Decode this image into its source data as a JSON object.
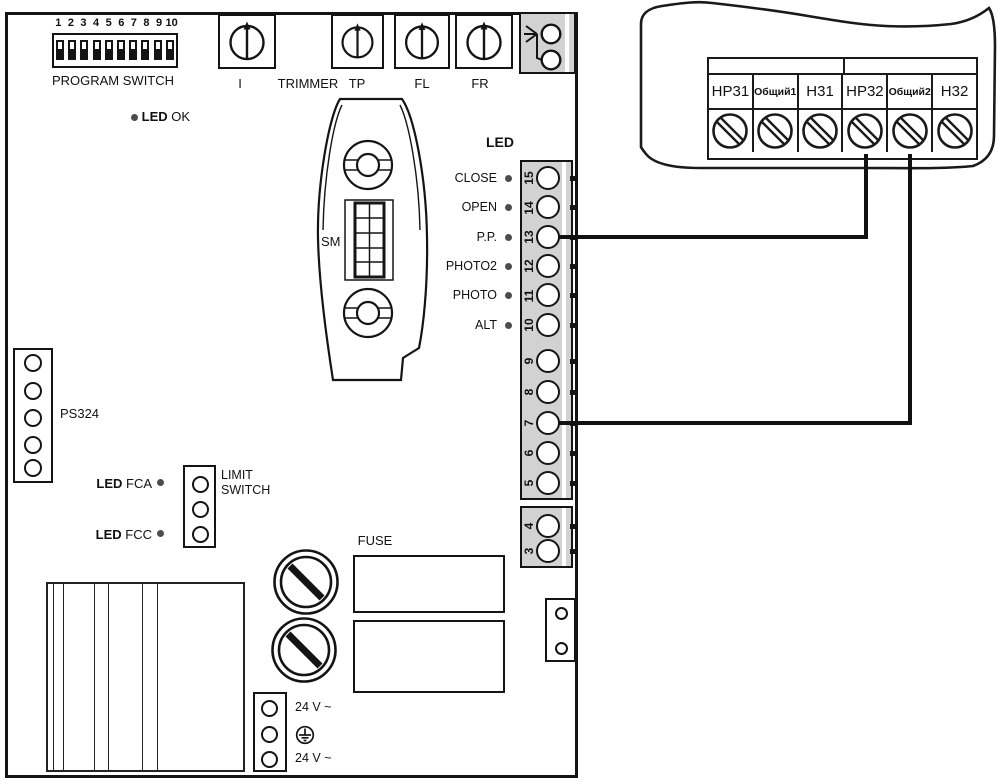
{
  "board": {
    "dip": {
      "numbers": [
        "1",
        "2",
        "3",
        "4",
        "5",
        "6",
        "7",
        "8",
        "9",
        "10"
      ],
      "label": "PROGRAM SWITCH"
    },
    "trimmers": {
      "i": "I",
      "trimmer": "TRIMMER",
      "tp": "TP",
      "fl": "FL",
      "fr": "FR"
    },
    "led_ok": {
      "led": "LED",
      "name": "OK"
    },
    "sm_label": "SM",
    "led_panel": {
      "title": "LED",
      "items": [
        "CLOSE",
        "OPEN",
        "P.P.",
        "PHOTO2",
        "PHOTO",
        "ALT"
      ]
    },
    "terminals_main": [
      "15",
      "14",
      "13",
      "12",
      "11",
      "10",
      "9",
      "8",
      "7",
      "6",
      "5"
    ],
    "terminals_aux": [
      "4",
      "3"
    ],
    "ps324": "PS324",
    "led_fca": {
      "led": "LED",
      "name": "FCA"
    },
    "led_fcc": {
      "led": "LED",
      "name": "FCC"
    },
    "limit_switch": {
      "line1": "LIMIT",
      "line2": "SWITCH"
    },
    "fuse_label": "FUSE",
    "power": {
      "line1": "24 V ~",
      "line2": "24 V ~"
    }
  },
  "receiver": {
    "terminals": [
      "НР31",
      "Общий1",
      "Н31",
      "НР32",
      "Общий2",
      "Н32"
    ]
  },
  "colors": {
    "line": "#141414",
    "strip_gray": "#d2d2d2",
    "led_dot": "#4c4c4c"
  }
}
